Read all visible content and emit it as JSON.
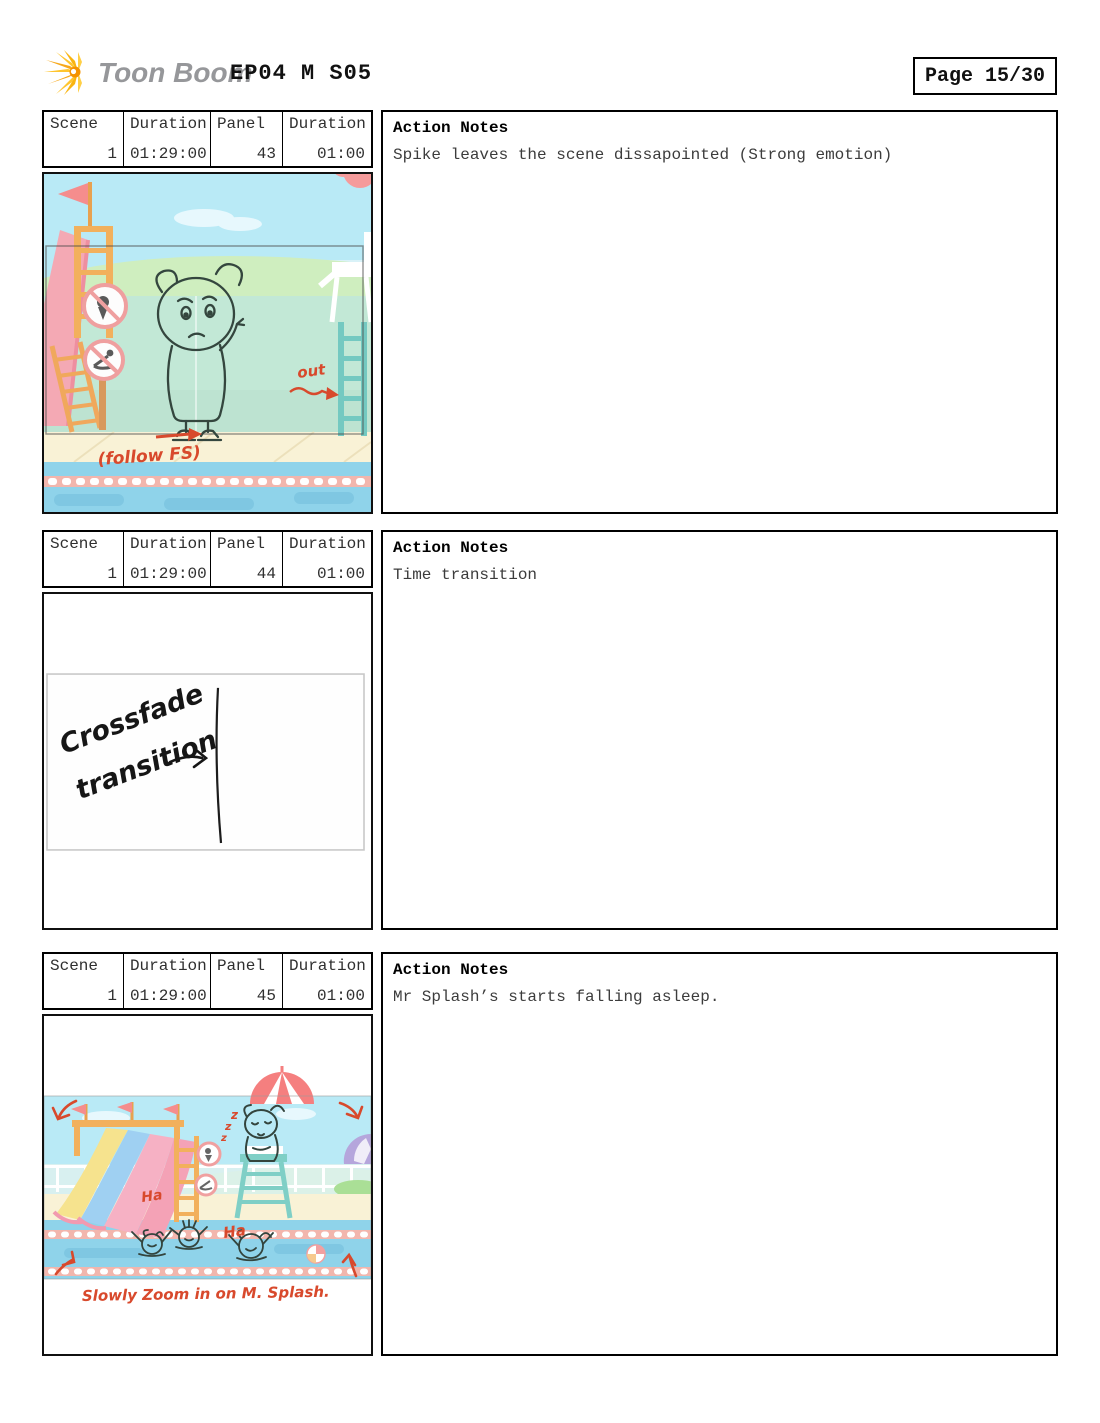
{
  "header": {
    "logo_text": "Toon Boom",
    "title": "EP04 M S05",
    "page_label": "Page 15/30"
  },
  "table_headers": {
    "scene": "Scene",
    "duration": "Duration",
    "panel": "Panel",
    "duration2": "Duration"
  },
  "rows": [
    {
      "scene": "1",
      "scene_duration": "01:29:00",
      "panel": "43",
      "panel_duration": "01:00",
      "action_title": "Action Notes",
      "action_text": "Spike leaves the scene dissapointed (Strong emotion)",
      "sketch": {
        "out_label": "out",
        "follow_label": "(follow FS)"
      }
    },
    {
      "scene": "1",
      "scene_duration": "01:29:00",
      "panel": "44",
      "panel_duration": "01:00",
      "action_title": "Action Notes",
      "action_text": "Time transition",
      "sketch": {
        "line1": "Crossfade",
        "line2": "transition"
      }
    },
    {
      "scene": "1",
      "scene_duration": "01:29:00",
      "panel": "45",
      "panel_duration": "01:00",
      "action_title": "Action Notes",
      "action_text": "Mr Splash’s starts falling asleep.",
      "sketch": {
        "z": "z",
        "ha": "Ha",
        "zoom_note": "Slowly Zoom in on M. Splash."
      }
    }
  ],
  "colors": {
    "annotation_red": "#d8492c",
    "logo_yellow": "#f9b410",
    "sky": "#b9eaf6",
    "wall_mint": "#c2e8d6",
    "water_blue": "#8fd3ea",
    "deck_cream": "#f9f2d6",
    "lane_rope_pink": "#f2b6ad"
  }
}
